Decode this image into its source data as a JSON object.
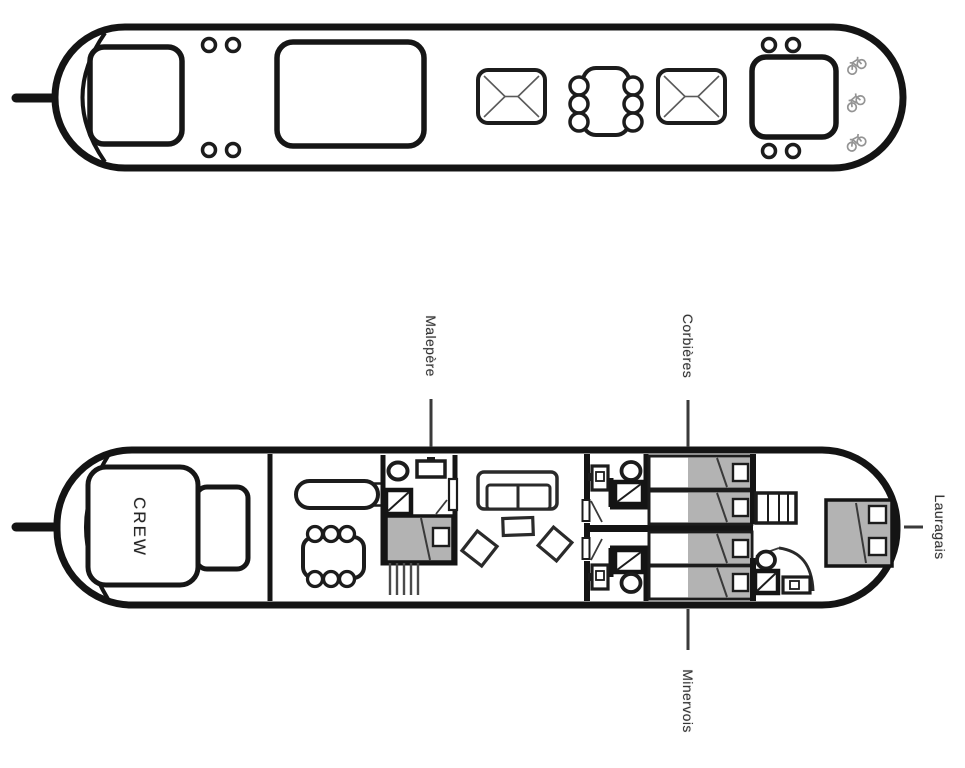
{
  "labels": {
    "crew": "CREW",
    "malepere": "Malepère",
    "corbieres": "Corbières",
    "minervois": "Minervois",
    "lauragais": "Lauragais"
  },
  "colors": {
    "background": "#ffffff",
    "hull_line": "#141414",
    "furniture_line": "#1c1c1c",
    "detail_line": "#555555",
    "bed_fill": "#b3b3b3",
    "bicycle_icon": "#949494",
    "label_text": "#343434",
    "connector_line": "#3a3a3a"
  },
  "decks": {
    "upper": {
      "elements": [
        "bow-mooring-line",
        "bow-hatch",
        "deck-bollards",
        "saloon-roof-hatch",
        "sun-lounger",
        "outdoor-dining-table-six-chairs",
        "sun-lounger",
        "stern-roof-hatch",
        "deck-bollards",
        "bicycle-icon",
        "bicycle-icon",
        "bicycle-icon"
      ]
    },
    "lower": {
      "elements": [
        "bow-mooring-line",
        "crew-quarters",
        "galley-bar-counter",
        "dining-table-six-chairs",
        "cabin-malepere-ensuite",
        "stairs",
        "saloon-sofa",
        "coffee-table",
        "armchairs",
        "cabin-corbieres-twin-ensuite",
        "cabin-minervois-twin-ensuite",
        "cabin-lauragais-double-ensuite",
        "wardrobe"
      ]
    }
  }
}
